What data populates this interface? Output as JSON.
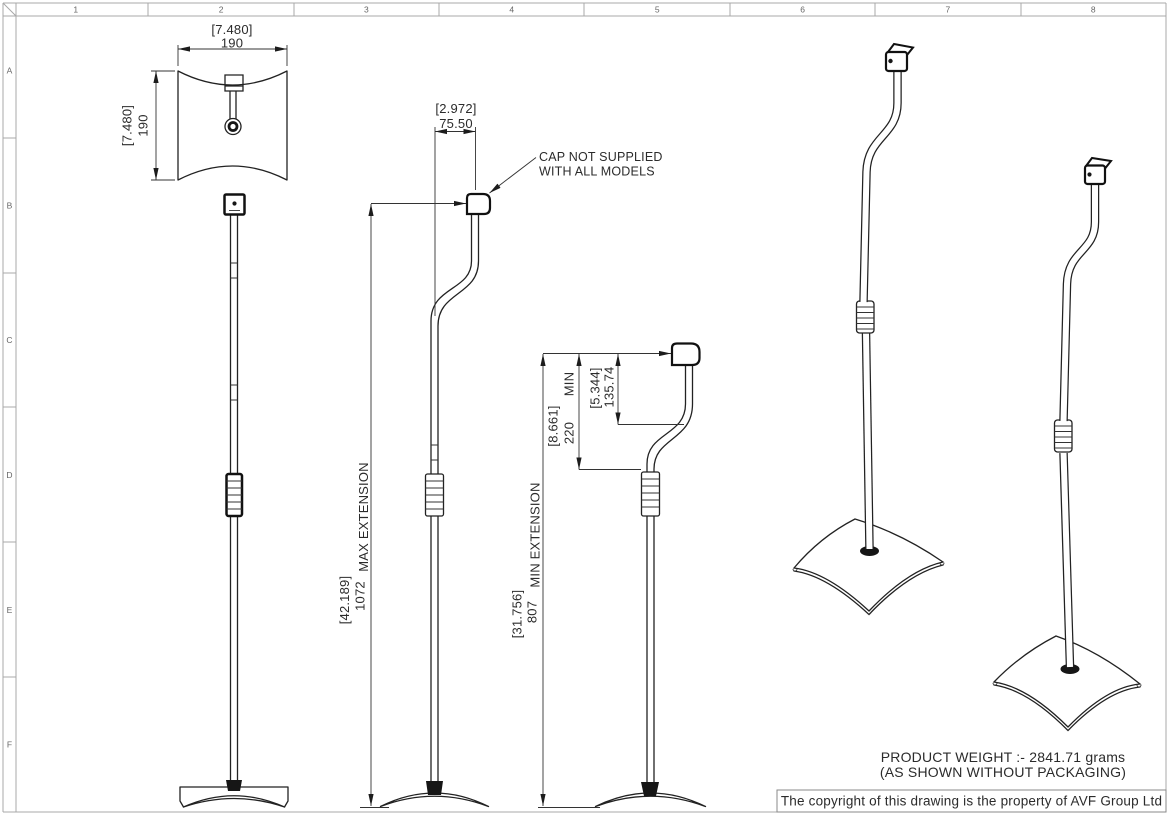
{
  "sheet": {
    "column_labels": [
      "1",
      "2",
      "3",
      "4",
      "5",
      "6",
      "7",
      "8"
    ],
    "row_labels": [
      "A",
      "B",
      "C",
      "D",
      "E",
      "F"
    ]
  },
  "top_view": {
    "width_in": "[7.480]",
    "width_mm": "190",
    "height_in": "[7.480]",
    "height_mm": "190"
  },
  "max_view": {
    "depth_in": "[2.972]",
    "depth_mm": "75.50",
    "extension_label": "MAX EXTENSION",
    "extension_in": "[42.189]",
    "extension_mm": "1072",
    "cap_note_line1": "CAP NOT SUPPLIED",
    "cap_note_line2": "WITH ALL MODELS"
  },
  "min_view": {
    "extension_label": "MIN EXTENSION",
    "extension_in": "[31.756]",
    "extension_mm": "807",
    "drop_label": "MIN",
    "drop_in": "[8.661]",
    "drop_mm": "220",
    "offset_in": "[5.344]",
    "offset_mm": "135.74"
  },
  "notes": {
    "weight_line1": "PRODUCT WEIGHT :- 2841.71 grams",
    "weight_line2": "(AS SHOWN WITHOUT PACKAGING)",
    "copyright": "The copyright of this drawing is the property of AVF Group Ltd"
  }
}
